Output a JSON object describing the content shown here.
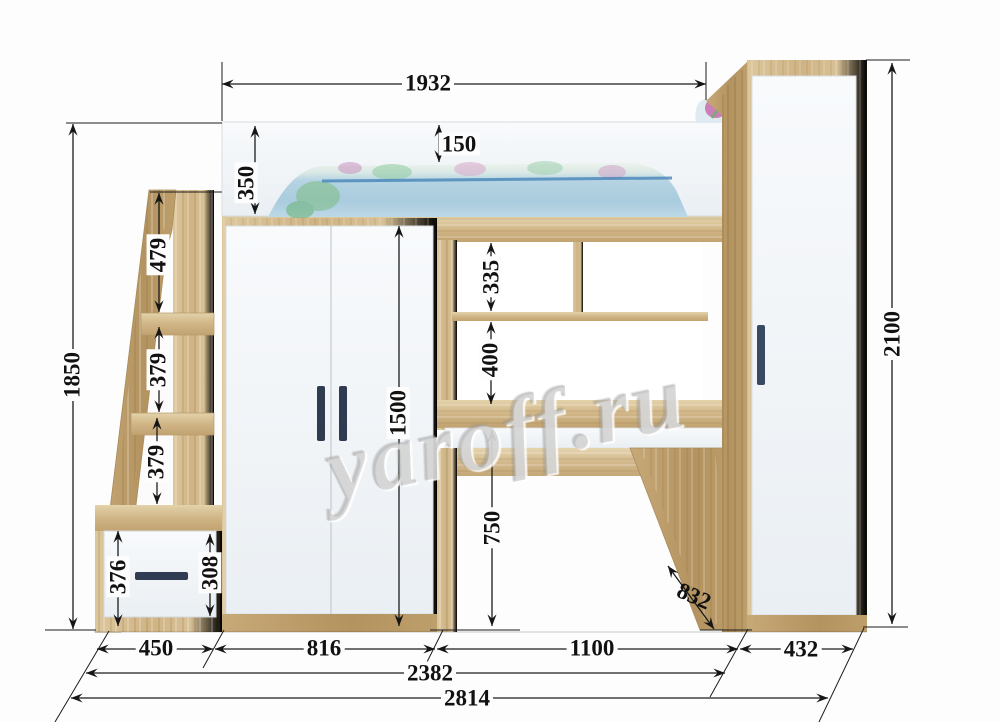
{
  "diagram": {
    "watermark": "yaroff.ru"
  },
  "dims": {
    "bed_length": "1932",
    "rail_height": "350",
    "mattress_above_rail": "150",
    "stairs_height": "1850",
    "stair_top_gap": "479",
    "stair_step_1": "379",
    "stair_step_2": "379",
    "drawer_module_height": "376",
    "drawer_front_height": "308",
    "wardrobe_height": "1500",
    "shelf_gap_top": "335",
    "shelf_gap_bottom": "400",
    "desk_clearance": "750",
    "desk_depth": "832",
    "total_height": "2100",
    "stairs_width": "450",
    "wardrobe_width": "816",
    "desk_width": "1100",
    "right_wardrobe_width": "432",
    "width_no_right_wardrobe": "2382",
    "total_width": "2814"
  }
}
